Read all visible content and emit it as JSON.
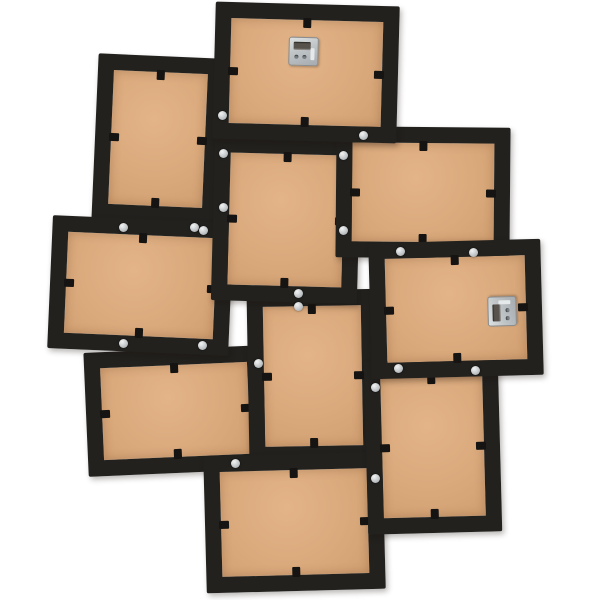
{
  "product_photo": {
    "background_color": "#ffffff",
    "frame_color": "#22211e",
    "mdf_color": "#daaa7d",
    "mdf_color_light": "#e3b488",
    "mdf_color_dark": "#d09f71",
    "screw_color": "#c3c7c9",
    "hanger_color": "#bfc4c7",
    "border_width": 16,
    "frames": [
      {
        "id": "photo-frame-back-top-center",
        "x": 214,
        "y": 4,
        "w": 184,
        "h": 137,
        "rot": 1.5,
        "z": 6,
        "hanger": {
          "x": 74,
          "y": 33,
          "rot": 0
        }
      },
      {
        "id": "photo-frame-back-top-left",
        "x": 95,
        "y": 56,
        "w": 126,
        "h": 166,
        "rot": 2.5,
        "z": 1,
        "hanger": null
      },
      {
        "id": "photo-frame-back-left-middle",
        "x": 50,
        "y": 219,
        "w": 181,
        "h": 133,
        "rot": 2.5,
        "z": 3,
        "hanger": null
      },
      {
        "id": "photo-frame-back-center",
        "x": 213,
        "y": 138,
        "w": 146,
        "h": 164,
        "rot": 1.5,
        "z": 4,
        "hanger": null
      },
      {
        "id": "photo-frame-back-upper-right",
        "x": 336,
        "y": 127,
        "w": 174,
        "h": 131,
        "rot": 0.5,
        "z": 5,
        "hanger": null
      },
      {
        "id": "photo-frame-back-right-middle",
        "x": 370,
        "y": 241,
        "w": 172,
        "h": 136,
        "rot": -1.5,
        "z": 6,
        "hanger": {
          "x": 117,
          "y": 57,
          "rot": -90
        }
      },
      {
        "id": "photo-frame-back-center-bottom",
        "x": 248,
        "y": 290,
        "w": 130,
        "h": 172,
        "rot": -1,
        "z": 3,
        "hanger": null
      },
      {
        "id": "photo-frame-back-bottom-right",
        "x": 366,
        "y": 360,
        "w": 134,
        "h": 173,
        "rot": -1.5,
        "z": 5,
        "hanger": null
      },
      {
        "id": "photo-frame-back-left-bottom",
        "x": 86,
        "y": 349,
        "w": 179,
        "h": 124,
        "rot": -2.5,
        "z": 2,
        "hanger": null
      },
      {
        "id": "photo-frame-back-bottom-center",
        "x": 205,
        "y": 454,
        "w": 179,
        "h": 137,
        "rot": -1.5,
        "z": 4,
        "hanger": null
      }
    ],
    "screws": [
      [
        222,
        115
      ],
      [
        223,
        153
      ],
      [
        223,
        207
      ],
      [
        194,
        227
      ],
      [
        123,
        227
      ],
      [
        203,
        230
      ],
      [
        363,
        135
      ],
      [
        343,
        155
      ],
      [
        343,
        230
      ],
      [
        298,
        293
      ],
      [
        298,
        306
      ],
      [
        400,
        251
      ],
      [
        473,
        252
      ],
      [
        123,
        343
      ],
      [
        202,
        345
      ],
      [
        258,
        363
      ],
      [
        398,
        368
      ],
      [
        475,
        370
      ],
      [
        375,
        387
      ],
      [
        235,
        463
      ],
      [
        375,
        478
      ]
    ]
  }
}
